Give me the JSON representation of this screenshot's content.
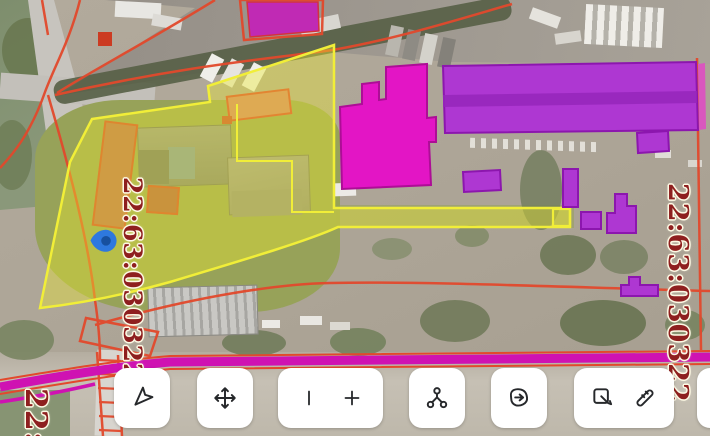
{
  "app": {
    "type": "public-cadastral-map",
    "view": "satellite"
  },
  "map": {
    "parcel_labels": {
      "left": "22:63:030322",
      "right": "22:63:030322",
      "bottom_partial": "22:"
    },
    "selected_parcel": {
      "cadastral_number": "22:63:030322",
      "outline_color": "#f1ee38",
      "fill_color": "rgba(236,233,48,0.40)"
    },
    "marker": {
      "name": "location-marker",
      "color": "#2e78de",
      "inner_color": "#17509f"
    },
    "colors": {
      "building_magenta": "#e315c5",
      "building_magenta_border": "#ad0d96",
      "building_purple": "#ae37d2",
      "building_purple_border": "#8c16ae",
      "boundary_red": "#e2492c",
      "road_magenta": "#cf12b2",
      "label_red": "#8e1f1f"
    }
  },
  "toolbar": {
    "buttons": [
      {
        "id": "navigate",
        "icon": "cursor-arrow-icon"
      },
      {
        "id": "pan",
        "icon": "move-icon"
      },
      {
        "id": "zoom-group",
        "icons": [
          "vertical-bar-icon",
          "plus-icon"
        ]
      },
      {
        "id": "nodes",
        "icon": "nodes-icon"
      },
      {
        "id": "polygon-select",
        "icon": "polygon-arrow-icon"
      },
      {
        "id": "edit-group",
        "icons": [
          "select-edit-icon",
          "ruler-icon"
        ]
      },
      {
        "id": "partial",
        "icon": "clipped-button"
      }
    ]
  }
}
